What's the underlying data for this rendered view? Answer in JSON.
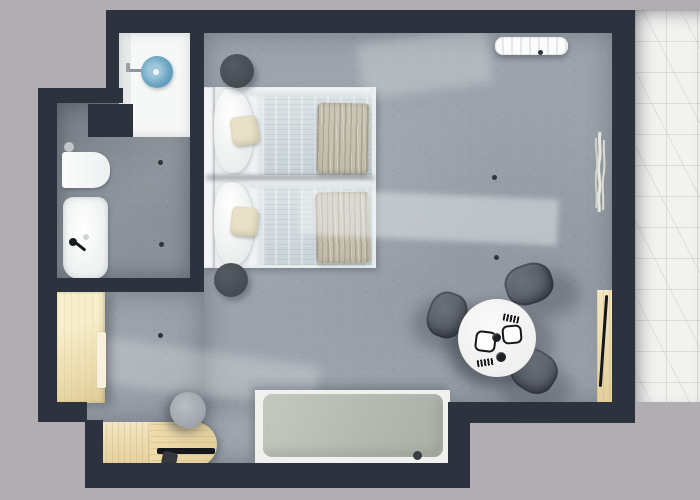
{
  "scene": {
    "type": "floor-plan",
    "description": "Top-down 3D rendering of a studio hotel room: bathroom with round blue washbasin, toilet and shower; twin beds with white linen; round dining table with three chairs; desk, wardrobe, daybed and marble terrace",
    "rooms": [
      "bathroom",
      "bedroom-living-area",
      "terrace"
    ]
  },
  "colors": {
    "bg": "#b0aeb0",
    "wall": "#2d333e",
    "floorMain": "#9ca3ac",
    "floorBath": "#8e959d",
    "marble": "#f2f2f0",
    "white": "#f6f7f7",
    "basin": "#6da6c3",
    "wood": "#e4cf9c",
    "woodLight": "#f3e6c0",
    "linen": "#eaedee",
    "duvet": "#c9d3d8",
    "throw": "#c2bbaa",
    "pillow": "#e8e1c9",
    "nightstand": "#484d55",
    "chair": "#595e68",
    "cushion": "#b4bab0",
    "deskChair": "#a3a8b0",
    "tableTop": "#eff0ee",
    "ink": "#14171b"
  },
  "furniture": {
    "bed_left": {
      "label": "Twin bed 1 - white linen with taupe throw"
    },
    "bed_right": {
      "label": "Twin bed 2 - white linen with taupe throw"
    },
    "nightstand_top": {
      "label": "Round nightstand"
    },
    "nightstand_bottom": {
      "label": "Round nightstand"
    },
    "dining_table": {
      "label": "Round dining table set for two"
    },
    "dining_chair": {
      "label": "Upholstered dining chair"
    },
    "daybed": {
      "label": "Daybed with sage cushion"
    },
    "desk": {
      "label": "Wooden desk"
    },
    "desk_chair": {
      "label": "Round desk chair"
    },
    "wardrobe": {
      "label": "Wooden wardrobe"
    },
    "sideboard": {
      "label": "Wall-mounted wooden console"
    },
    "radiator": {
      "label": "Radiator"
    },
    "plant": {
      "label": "Dried plant decor"
    },
    "toilet": {
      "label": "Toilet"
    },
    "shower": {
      "label": "Shower tray"
    },
    "washbasin": {
      "label": "Round blue washbasin on vanity"
    }
  }
}
